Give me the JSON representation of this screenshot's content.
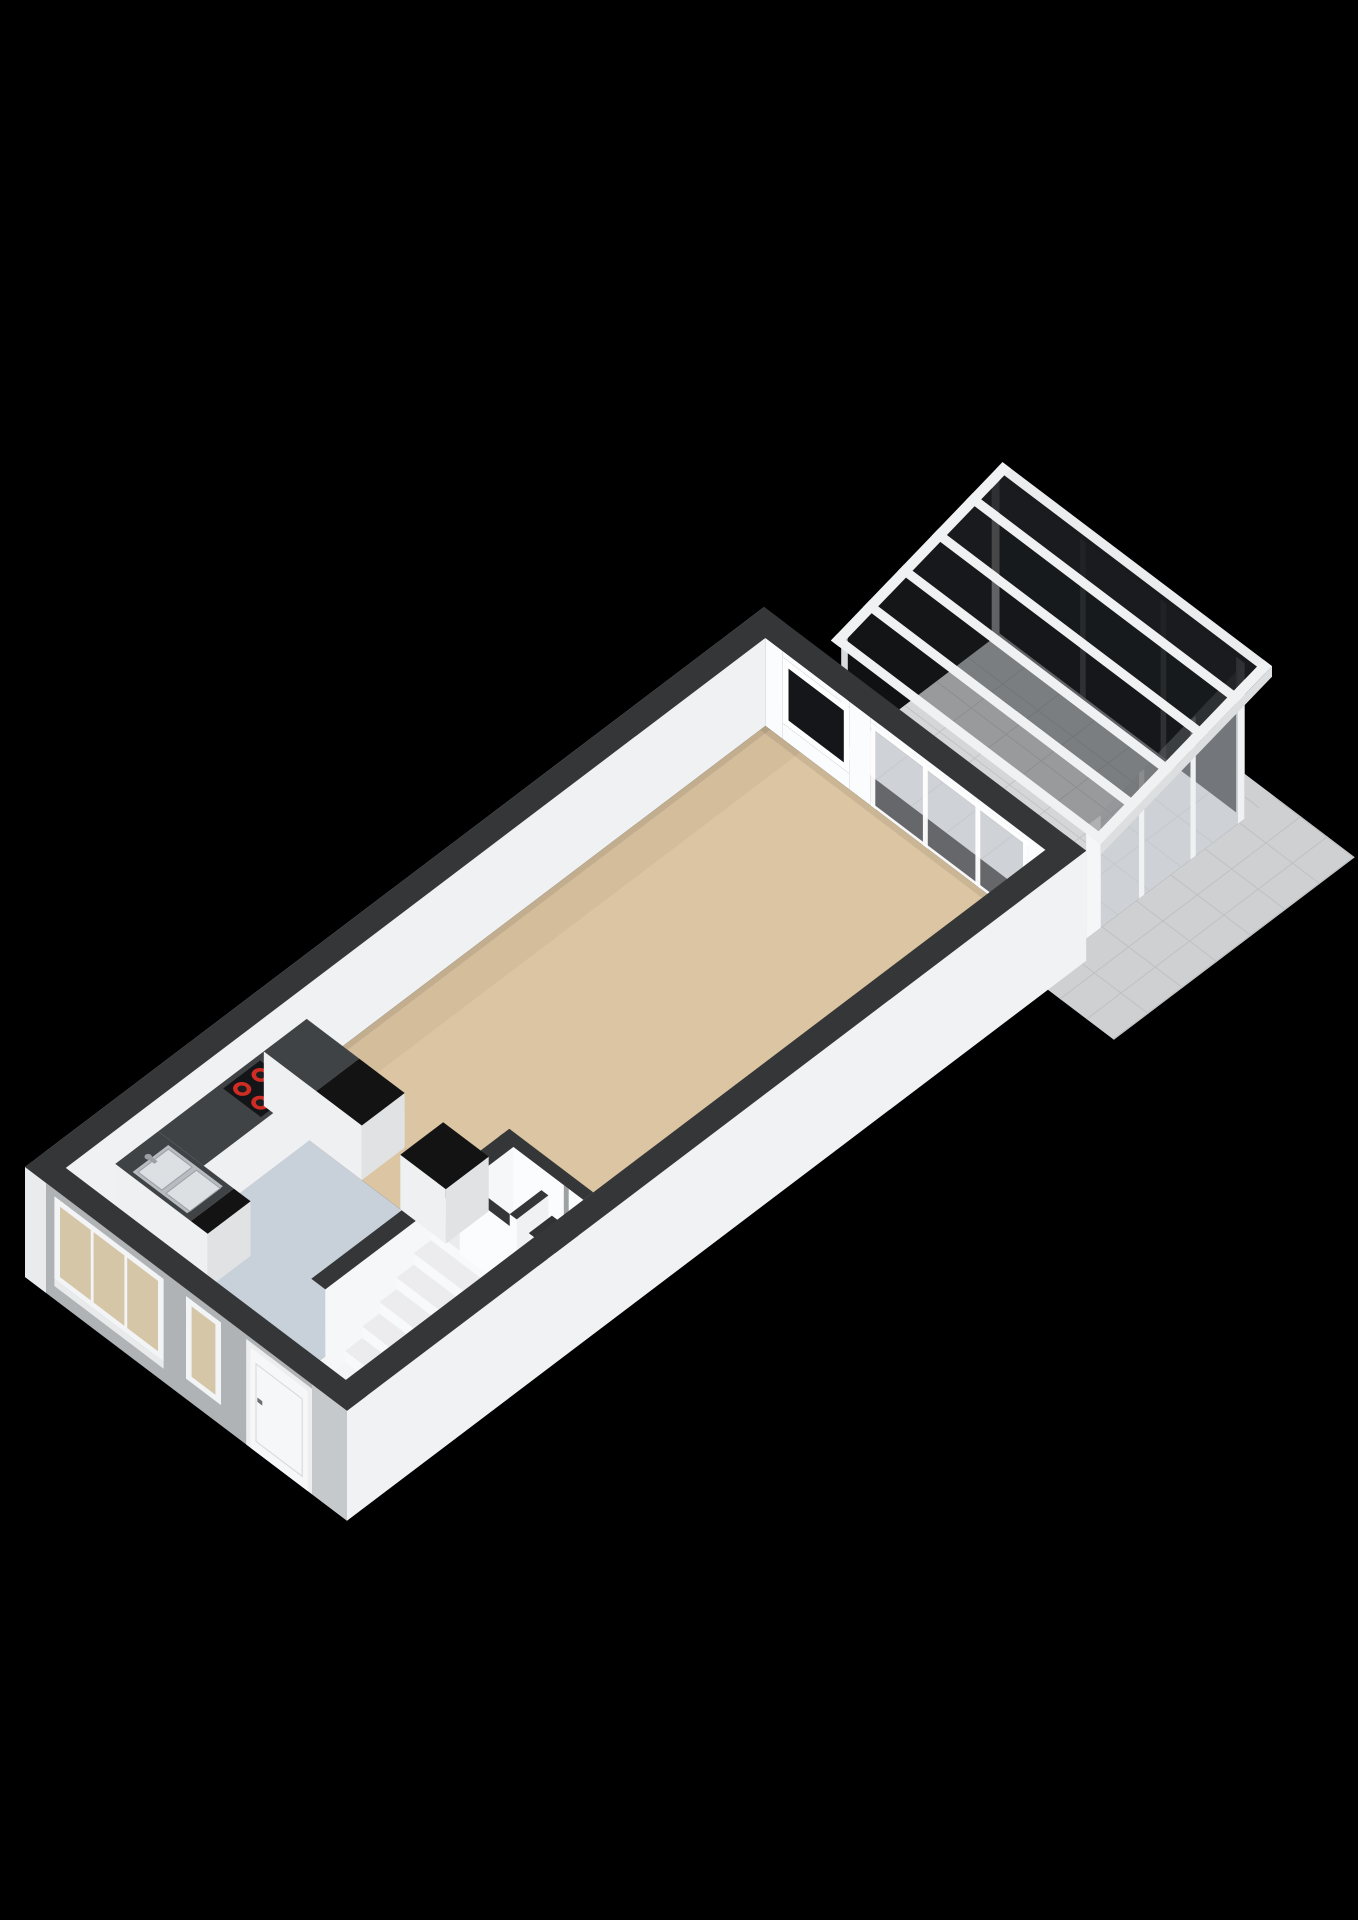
{
  "scene": {
    "type": "3d-floor-plan-render",
    "style": "isometric-birdseye-cutaway",
    "background_color": "#000000",
    "palette": {
      "capDark": "#343638",
      "wallWhiteExt": "#f5f6f7",
      "wallWhiteExt2": "#f1f2f3",
      "wallInt": "#fbfcfd",
      "wallInt2": "#eff1f2",
      "wallSoft": "#f6f7f8",
      "facade": "#b0b3b6",
      "facadeLight": "#c6c9cb",
      "wallEnd": "#e9ebec",
      "floorLiving": "#dcc5a2",
      "floorKitchen": "#c8d1da",
      "floorHall": "#f4f5f6",
      "floorCons": "#d4d6d8",
      "gridCons": "#c2c4c6",
      "floorPatio": "#ced0d2",
      "gridPatio": "#bfc1c3",
      "counterDark": "#404345",
      "counterBlack": "#131313",
      "cabinetFace": "#eef0f1",
      "cabinetSide": "#e0e2e4",
      "cooktopBlack": "#141518",
      "burnerRed": "#cf2d24",
      "burnerCore": "#1c1d1f",
      "sinkSteel": "#b7bcc0",
      "sinkBowl": "#dde0e2",
      "sinkEdge": "#9aa1a6",
      "faucetGray": "#9ba0a4",
      "stepTread": "#ececee",
      "stepRiser": "#f8f9fa",
      "glassDark": "#1b1d20",
      "glassDarker": "#101214",
      "glassDarkest": "#0d0f11",
      "beamWhite": "#eff1f2",
      "fascia": "#dcdee0",
      "glassSlider": "#c9ced3",
      "glassRear": "#14161a",
      "glassFacade": "#d6c6a8",
      "doorWhite": "#f6f7f8",
      "doorFrame": "#eceeef",
      "doorLine": "#d5d7d9",
      "handleDark": "#6b6f72",
      "heaterWhite": "#f3f4f5",
      "heaterTop": "#303234",
      "heaterSlot": "#2a2b2d",
      "heaterRed": "#c0392b",
      "pipeGray": "#85898c",
      "shadow": "#000000"
    },
    "building": {
      "walls": "white exterior with dark charcoal cut tops, grey street facade",
      "rooms": [
        {
          "id": "living-room",
          "floor": "beige",
          "floor_color_key": "floorLiving"
        },
        {
          "id": "kitchen",
          "floor": "blue-grey",
          "floor_color_key": "floorKitchen",
          "fixtures": [
            "u-shaped-counter",
            "cooktop",
            "double-sink",
            "peninsula-cabinet",
            "island-cabinet"
          ]
        },
        {
          "id": "hallway",
          "floor": "white",
          "floor_color_key": "floorHall",
          "fixtures": [
            "staircase",
            "heater-niche",
            "storage-niche"
          ]
        },
        {
          "id": "entry",
          "floor": "beige",
          "floor_color_key": "floorLiving",
          "fixtures": [
            "front-door",
            "large-window",
            "narrow-window"
          ]
        },
        {
          "id": "conservatory",
          "floor": "grey-tiles",
          "floor_color_key": "floorCons",
          "fixtures": [
            "glass-roof",
            "glazed-walls",
            "sliding-door",
            "rear-window"
          ]
        },
        {
          "id": "patio",
          "floor": "grey-tiles",
          "floor_color_key": "floorPatio"
        }
      ]
    },
    "fixtures": {
      "cooktop": {
        "burners": 4,
        "burner_color_key": "burnerRed"
      },
      "sink": {
        "bowls": 2
      },
      "staircase": {
        "visible_steps": 5
      },
      "glass_roof": {
        "bays": 5,
        "bay_opacities": [
          0.32,
          0.48,
          0.63,
          0.78,
          0.9
        ]
      },
      "sliding_door": {
        "panels": 3
      },
      "large_window": {
        "panes": 3
      }
    }
  }
}
